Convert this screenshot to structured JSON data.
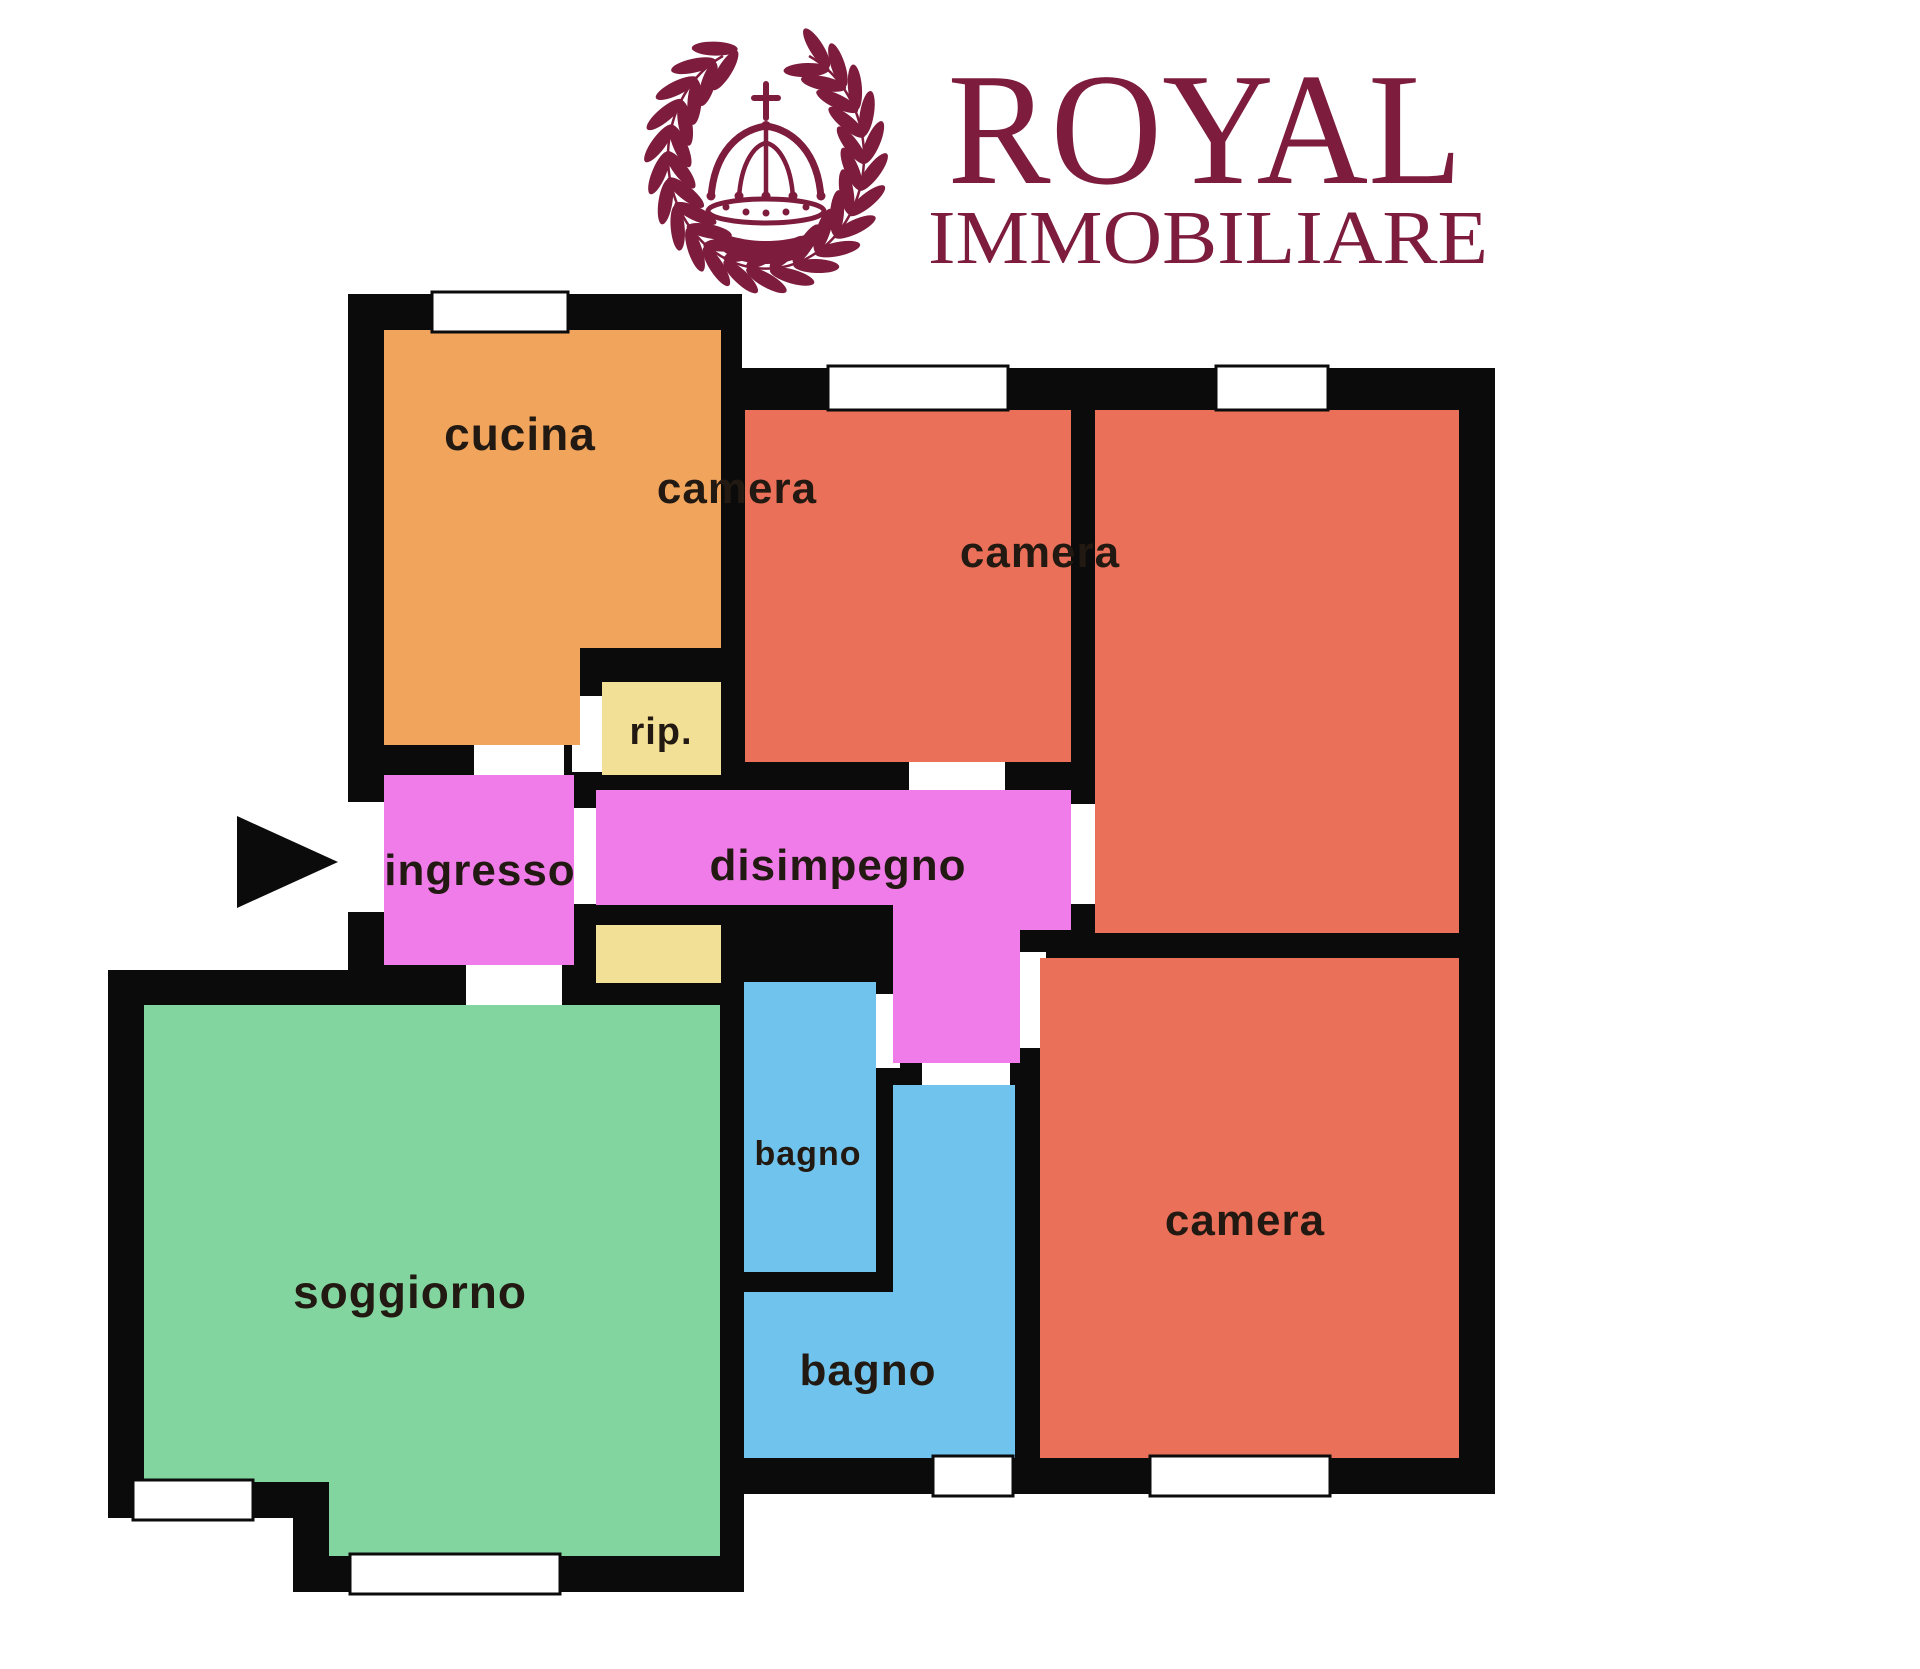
{
  "logo": {
    "title": "ROYAL",
    "subtitle": "IMMOBILIARE",
    "color": "#7d1c3d",
    "emblem": "laurel-wreath-crown"
  },
  "floorplan": {
    "wall_color": "#0b0b0b",
    "label_color": "#221a12",
    "colors": {
      "kitchen": "#f1a45c",
      "bedroom": "#eb7059",
      "hall": "#ef7ce9",
      "storage": "#f2e096",
      "living": "#83d5a0",
      "bath": "#6fc3ec"
    },
    "rooms": [
      {
        "id": "cucina",
        "label": "cucina",
        "type": "kitchen"
      },
      {
        "id": "camera-top",
        "label": "camera",
        "type": "bedroom"
      },
      {
        "id": "camera-right",
        "label": "camera",
        "type": "bedroom"
      },
      {
        "id": "camera-bottom",
        "label": "camera",
        "type": "bedroom"
      },
      {
        "id": "rip",
        "label": "rip.",
        "type": "storage"
      },
      {
        "id": "ingresso",
        "label": "ingresso",
        "type": "hall"
      },
      {
        "id": "disimpegno",
        "label": "disimpegno",
        "type": "hall"
      },
      {
        "id": "soggiorno",
        "label": "soggiorno",
        "type": "living"
      },
      {
        "id": "bagno-small",
        "label": "bagno",
        "type": "bath"
      },
      {
        "id": "bagno-large",
        "label": "bagno",
        "type": "bath"
      }
    ]
  }
}
